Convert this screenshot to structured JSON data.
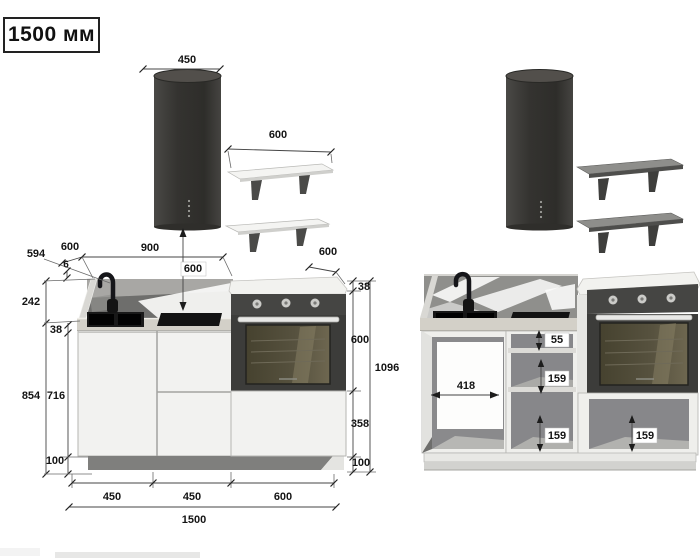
{
  "title": "1500 мм",
  "front_view": {
    "hood_width": "450",
    "shelf_width": "600",
    "worktop_depth": "594",
    "splash_gap": "6",
    "counter_depth": "600",
    "back_span": "900",
    "hood_clearance": "600",
    "backsplash_height": "242",
    "worktop_thickness": "38",
    "base_total_height": "854",
    "front_height": "716",
    "plinth_height": "100",
    "oven_depth": "600",
    "oven_top_thickness": "38",
    "oven_height": "600",
    "oven_column_height": "1096",
    "oven_drawer_height": "358",
    "oven_plinth_height": "100",
    "widths": {
      "w1": "450",
      "w2": "450",
      "w3": "600",
      "total": "1500"
    }
  },
  "open_view": {
    "cabinet_inner_width": "418",
    "top_drawer_clearance": "55",
    "middle_drawer_clearance": "159",
    "lower_drawer_clearance": "159",
    "oven_drawer_clearance": "159"
  },
  "colors": {
    "hood": "#383734",
    "oven_panel": "#454543",
    "backsplash": "#6e6e6c",
    "marble_splash": "#8f8f8c",
    "worktop": "#d3d0c8",
    "cabinet_front": "#f2f2f0",
    "plinth": "#7f7f7d",
    "dimension_text": "#141414"
  }
}
